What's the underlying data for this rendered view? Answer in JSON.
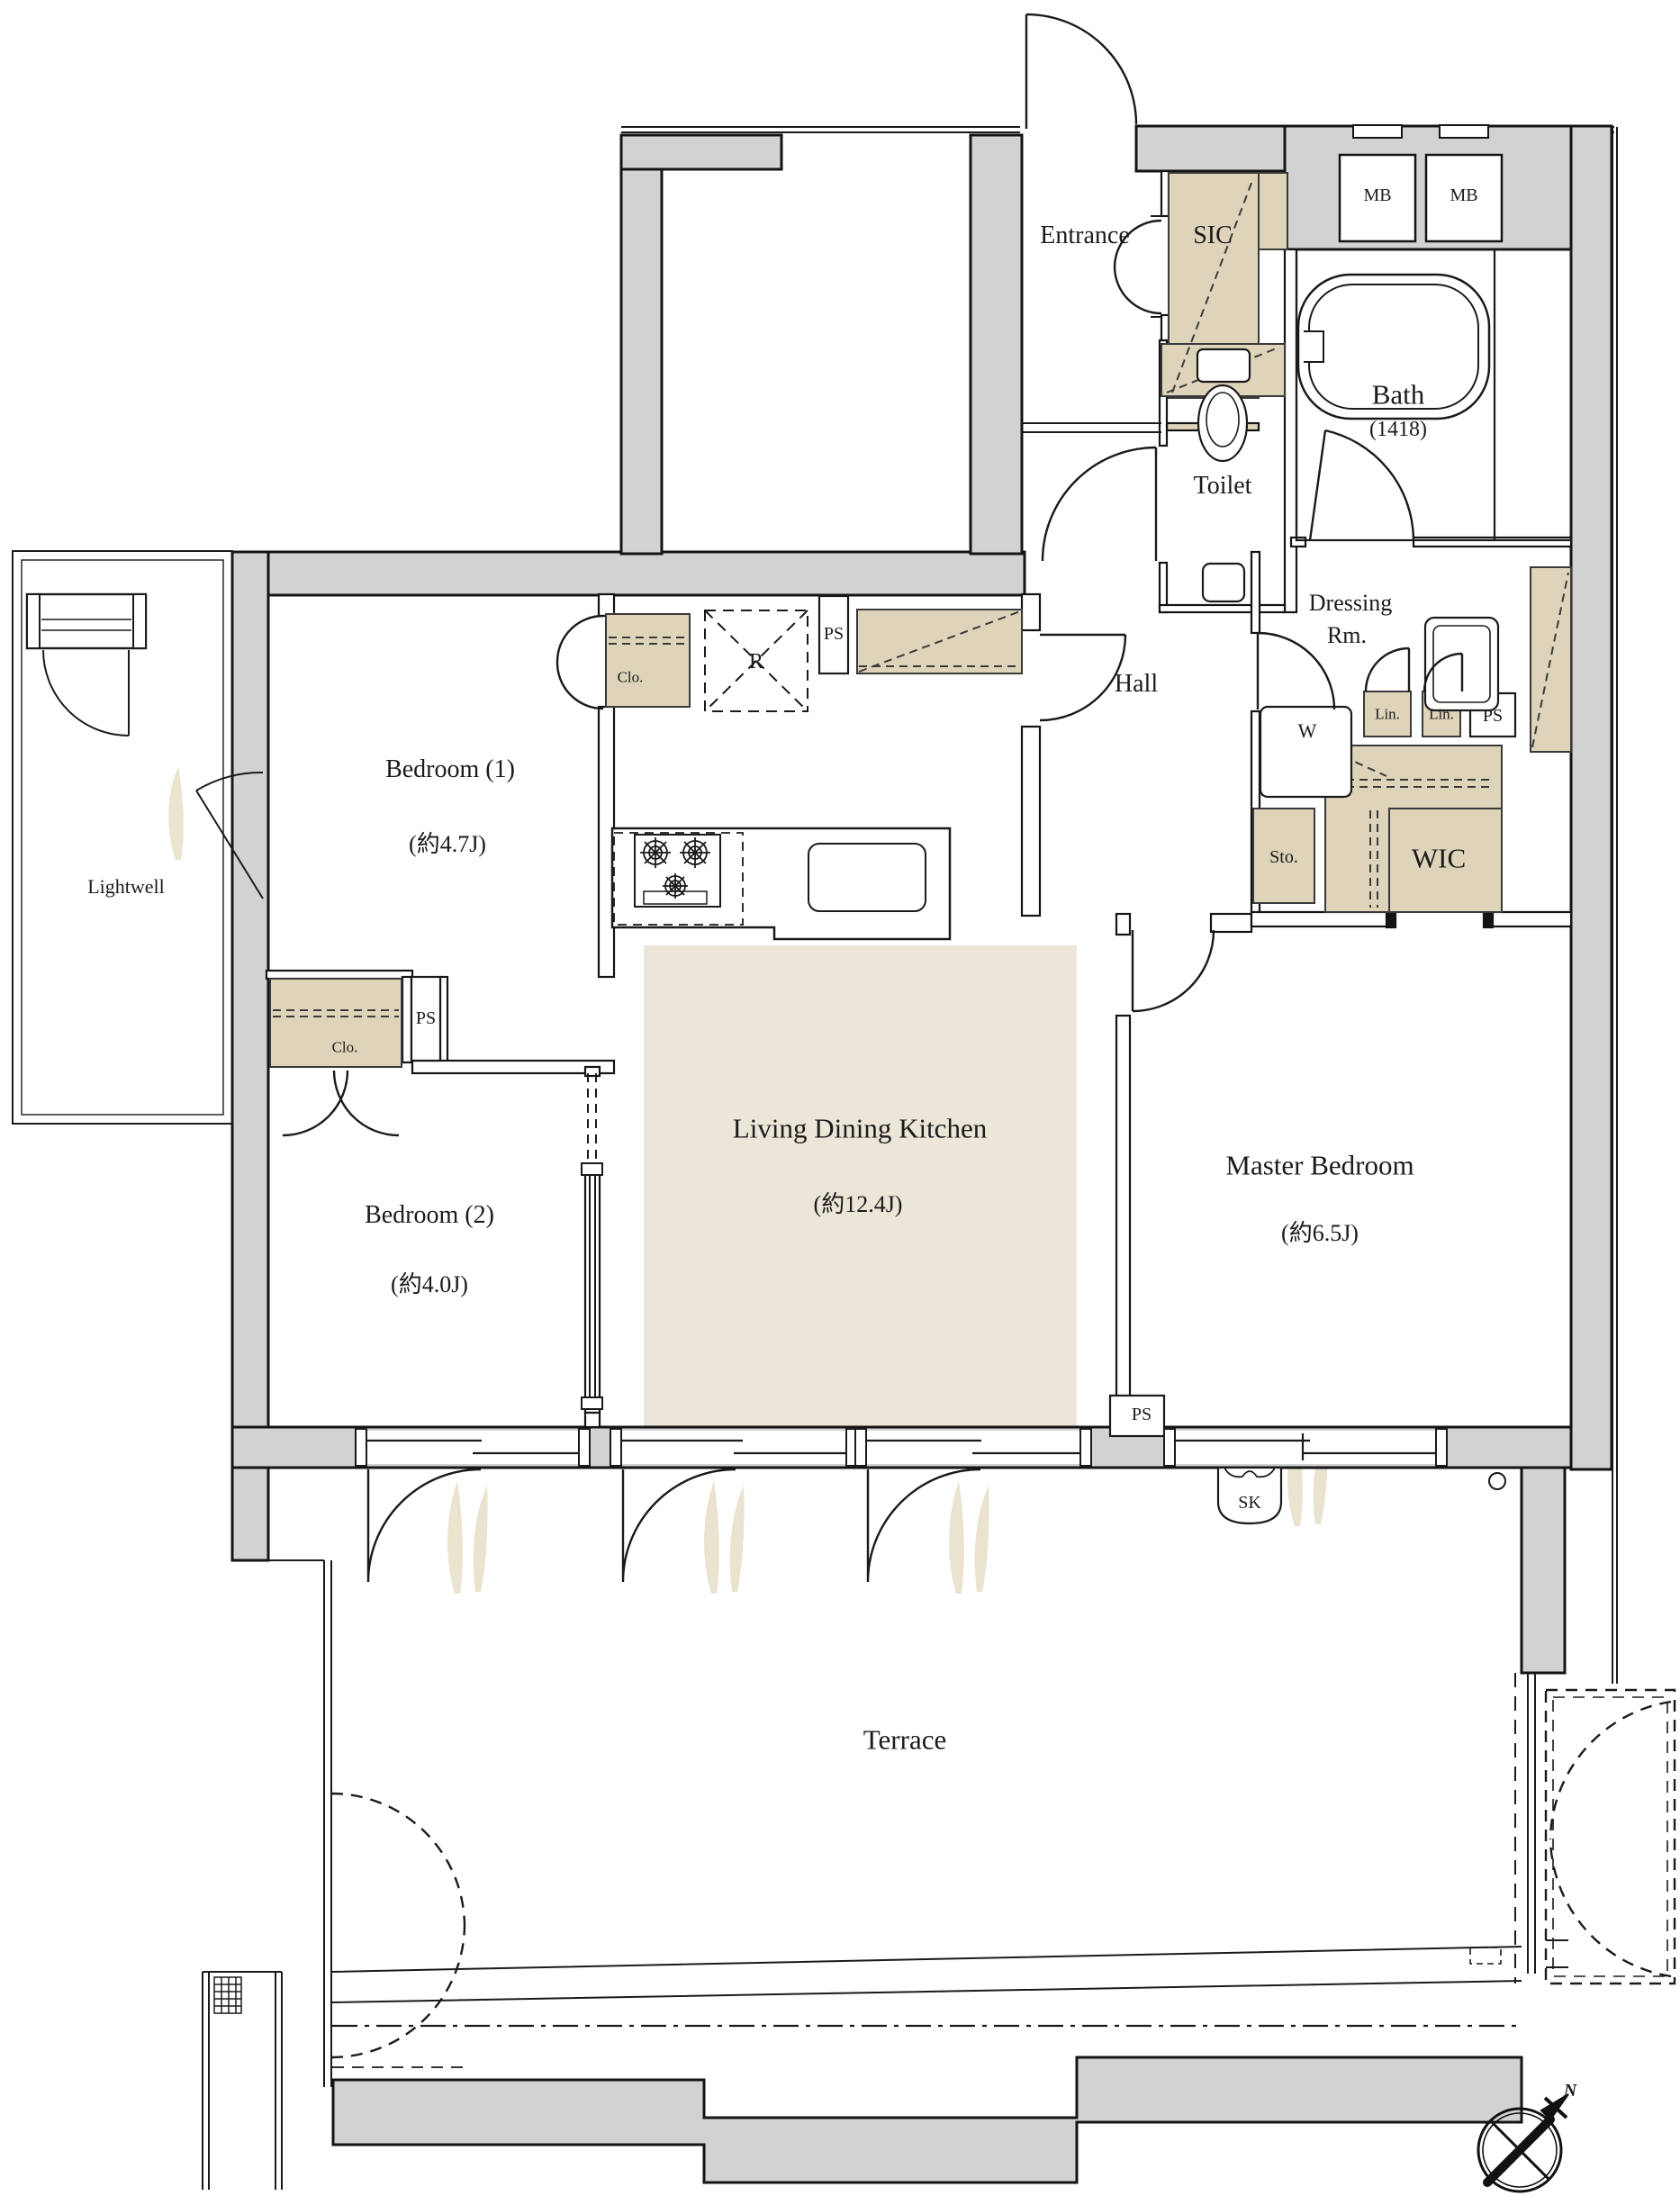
{
  "plan": {
    "rooms": {
      "entrance": {
        "label": "Entrance"
      },
      "sic": {
        "label": "SIC"
      },
      "bath": {
        "label": "Bath",
        "size": "(1418)"
      },
      "toilet": {
        "label": "Toilet"
      },
      "hall": {
        "label": "Hall"
      },
      "dressing": {
        "label_line1": "Dressing",
        "label_line2": "Rm."
      },
      "wic": {
        "label": "WIC"
      },
      "bedroom1": {
        "label": "Bedroom (1)",
        "size": "(約4.7J)"
      },
      "bedroom2": {
        "label": "Bedroom (2)",
        "size": "(約4.0J)"
      },
      "ldk": {
        "label": "Living Dining Kitchen",
        "size": "(約12.4J)"
      },
      "master": {
        "label": "Master Bedroom",
        "size": "(約6.5J)"
      },
      "lightwell": {
        "label": "Lightwell"
      },
      "terrace": {
        "label": "Terrace"
      }
    },
    "fixtures": {
      "meter_box_1": "MB",
      "meter_box_2": "MB",
      "washer": "W",
      "linen_1": "Lin.",
      "linen_2": "Lin.",
      "storage": "Sto.",
      "closet_bedroom1": "Clo.",
      "closet_bedroom2": "Clo.",
      "refrigerator": "R",
      "slop_sink": "SK",
      "ps_kitchen": "PS",
      "ps_bedroom": "PS",
      "ps_dressing": "PS",
      "ps_master": "PS"
    },
    "compass": {
      "north": "N"
    },
    "colors": {
      "wall_fill": "#d2d2d2",
      "closet_fill": "#ddd4ba",
      "ldk_floor_fill": "#ebe6d7",
      "line": "#1a1a1a"
    }
  }
}
